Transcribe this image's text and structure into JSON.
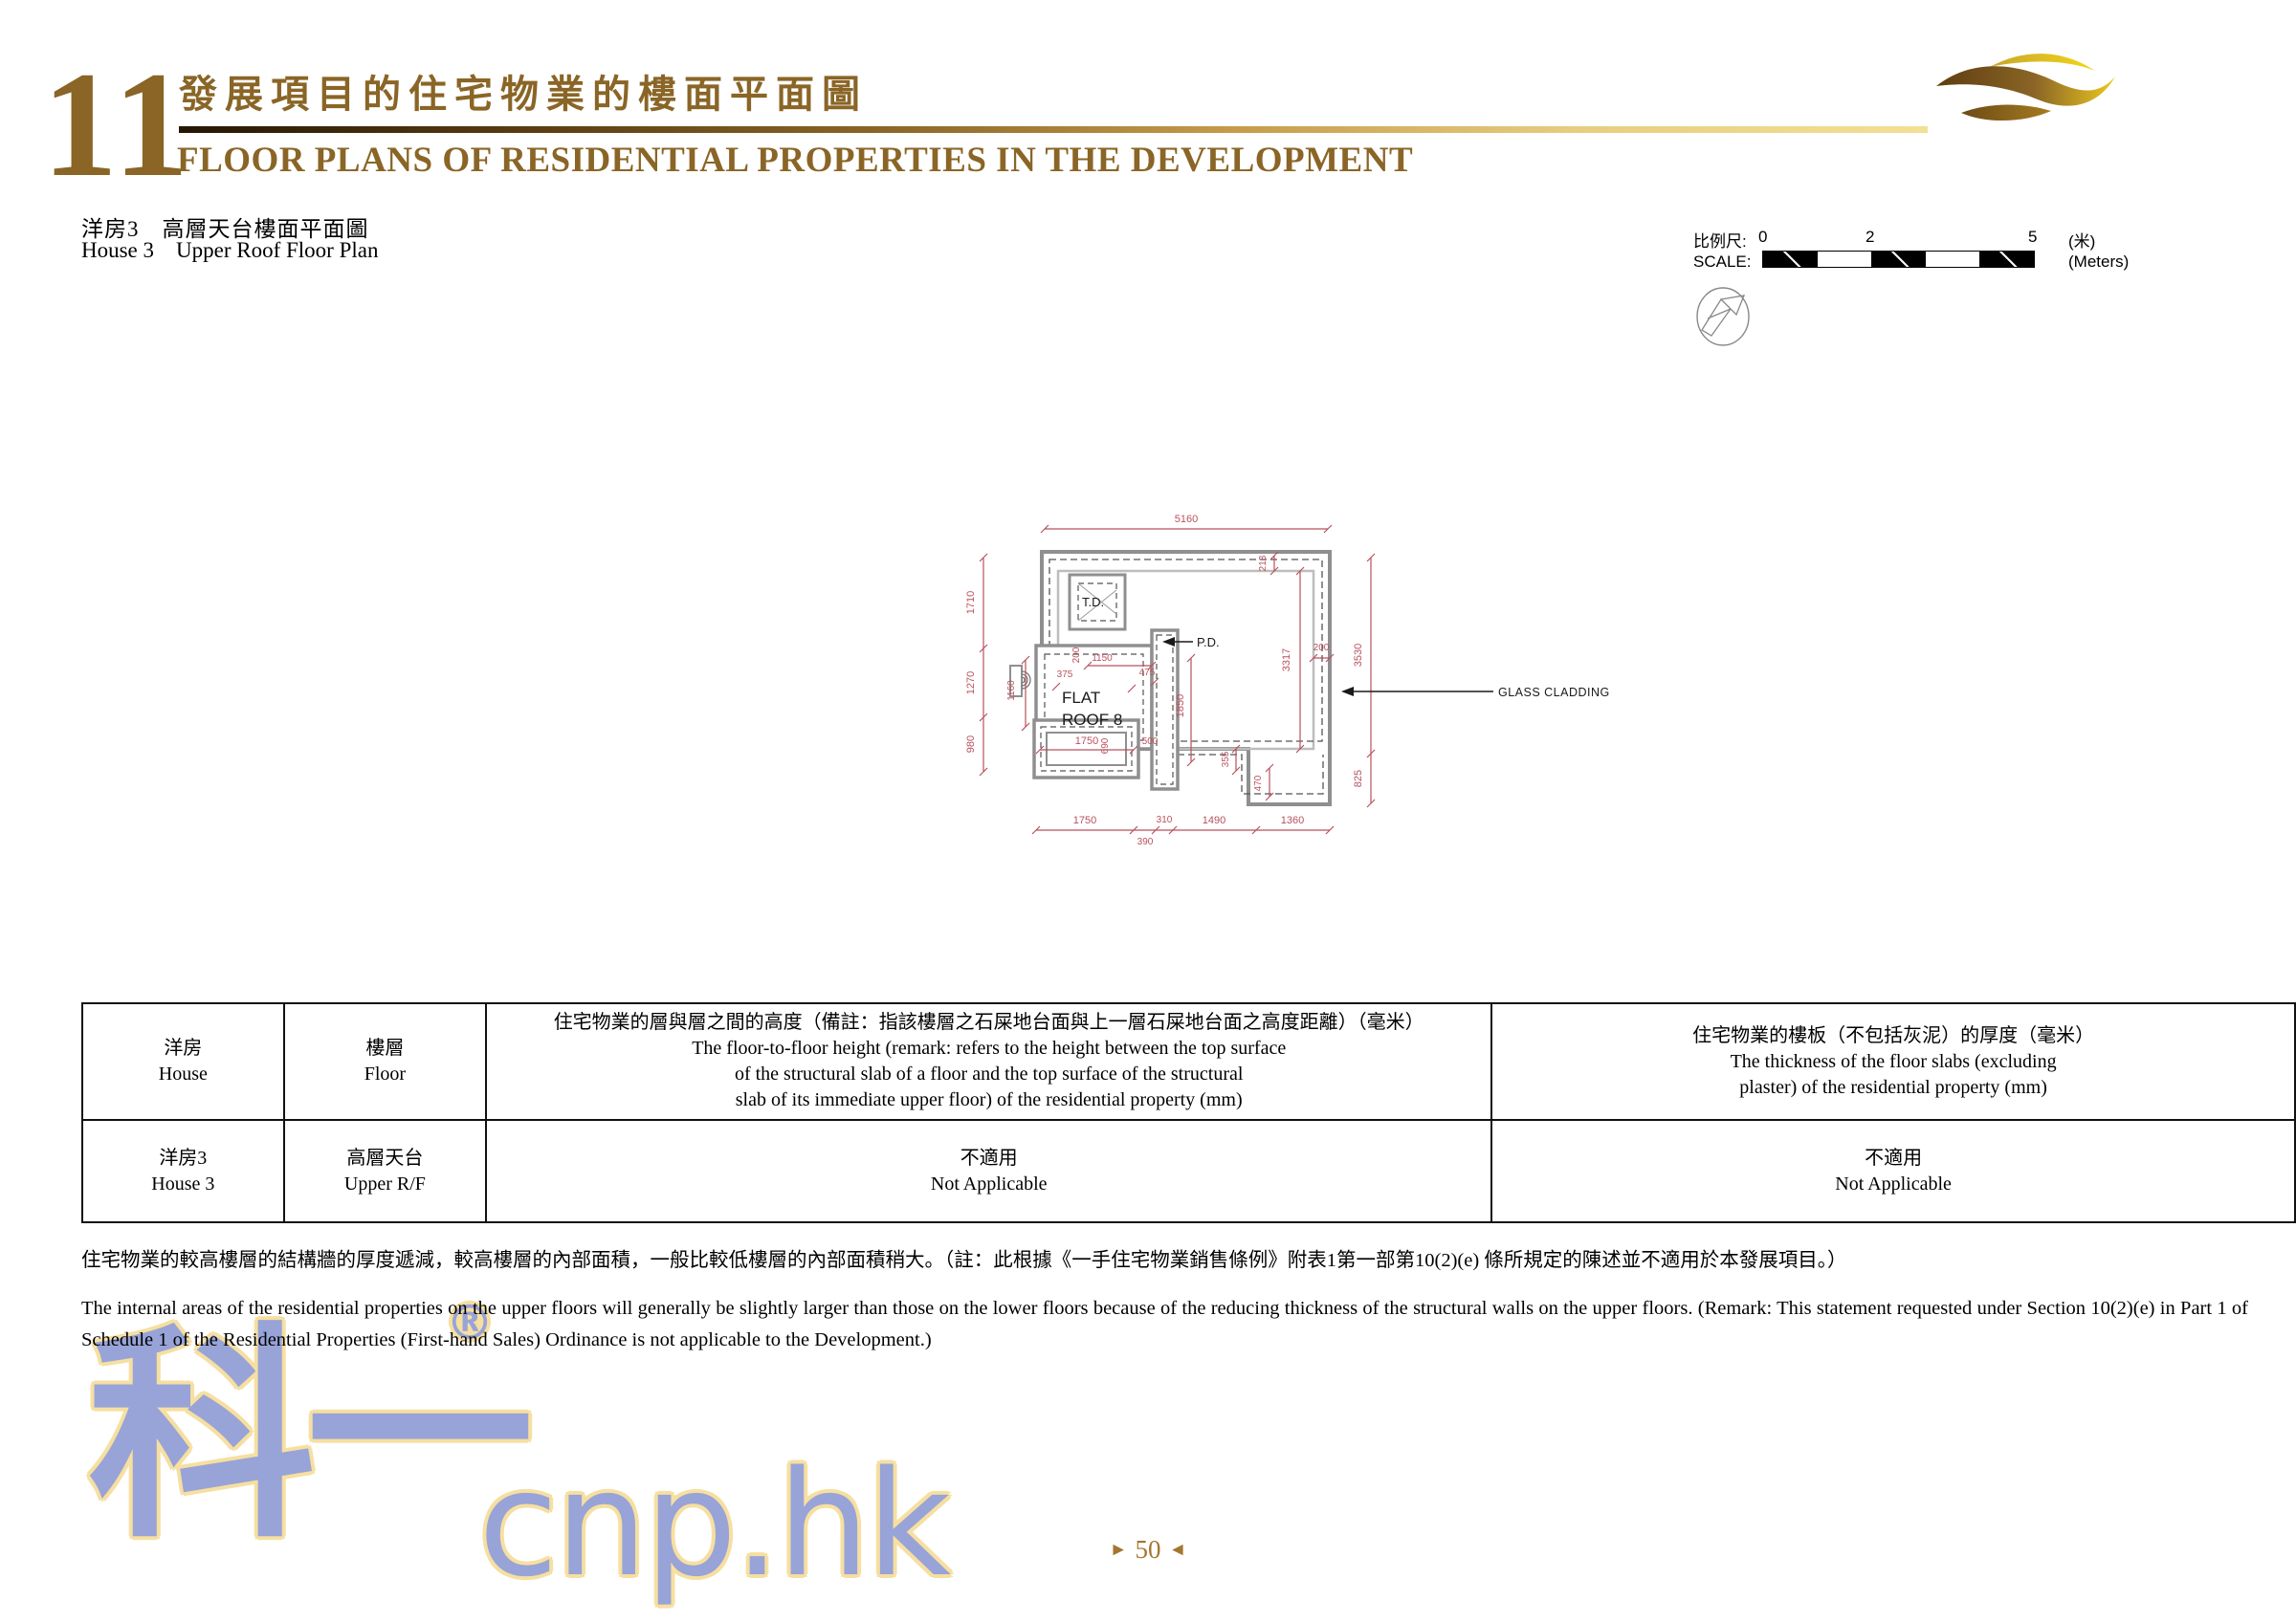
{
  "header": {
    "chapter_number": "11",
    "title_zh": "發展項目的住宅物業的樓面平面圖",
    "title_en": "FLOOR PLANS OF RESIDENTIAL PROPERTIES IN THE DEVELOPMENT"
  },
  "subheader": {
    "zh": "洋房3　高層天台樓面平面圖",
    "en": "House 3    Upper Roof Floor Plan"
  },
  "scale_bar": {
    "label_zh": "比例尺:",
    "label_en": "SCALE:",
    "tick_0": "0",
    "tick_2": "2",
    "tick_5": "5",
    "unit_zh": "(米)",
    "unit_en": "(Meters)"
  },
  "plan": {
    "labels": {
      "td": "T.D.",
      "pd": "P.D.",
      "room_line1": "FLAT",
      "room_line2": "ROOF 8",
      "glass_cladding": "GLASS CLADDING"
    },
    "dims": {
      "top": "5160",
      "left": [
        "1710",
        "1270",
        "980"
      ],
      "right": [
        "3530",
        "825"
      ],
      "inner": {
        "d213": "213",
        "d3317": "3317",
        "d200_right": "200",
        "d1150": "1150",
        "d200_left": "200",
        "d375": "375",
        "d475": "475",
        "d1850": "1850",
        "d1750_box": "1750",
        "d690": "690",
        "d500": "500",
        "d355": "355",
        "d470": "470",
        "d1160": "1160"
      },
      "bottom": [
        "1750",
        "310",
        "1490",
        "1360"
      ],
      "bottom_offset": "390"
    }
  },
  "table": {
    "header": {
      "c1": {
        "zh": "洋房",
        "en": "House"
      },
      "c2": {
        "zh": "樓層",
        "en": "Floor"
      },
      "c3": {
        "zh": "住宅物業的層與層之間的高度（備註：指該樓層之石屎地台面與上一層石屎地台面之高度距離）（毫米）",
        "en1": "The floor-to-floor height (remark: refers to the height between the top surface",
        "en2": "of the structural slab of a floor and the top surface of the structural",
        "en3": "slab of its immediate upper floor) of the residential property (mm)"
      },
      "c4": {
        "zh": "住宅物業的樓板（不包括灰泥）的厚度（毫米）",
        "en1": "The thickness of the floor slabs (excluding",
        "en2": "plaster) of the residential property (mm)"
      }
    },
    "row": {
      "c1": {
        "zh": "洋房3",
        "en": "House 3"
      },
      "c2": {
        "zh": "高層天台",
        "en": "Upper R/F"
      },
      "c3": {
        "zh": "不適用",
        "en": "Not Applicable"
      },
      "c4": {
        "zh": "不適用",
        "en": "Not Applicable"
      }
    }
  },
  "notes": {
    "zh": "住宅物業的較高樓層的結構牆的厚度遞減，較高樓層的內部面積，一般比較低樓層的內部面積稍大。（註：此根據《一手住宅物業銷售條例》附表1第一部第10(2)(e) 條所規定的陳述並不適用於本發展項目。）",
    "en": "The internal areas of the residential properties on the upper floors will generally be slightly larger than those on the lower floors because of the reducing thickness of the structural walls on the upper floors. (Remark: This statement requested under Section 10(2)(e) in Part 1 of Schedule 1 of the Residential Properties (First-hand Sales) Ordinance is not applicable to the Development.)"
  },
  "watermark": {
    "cjk": "科一",
    "reg": "®",
    "latin": "cnp.hk"
  },
  "footer": {
    "prev_arrow": "►",
    "page": "50",
    "next_arrow": "◄"
  },
  "colors": {
    "gold": "#8a6526",
    "dim_red": "#b8515e",
    "wall_gray": "#8f8f8f",
    "watermark_blue": "#98a3d8",
    "watermark_outline": "#f6dfa0"
  }
}
